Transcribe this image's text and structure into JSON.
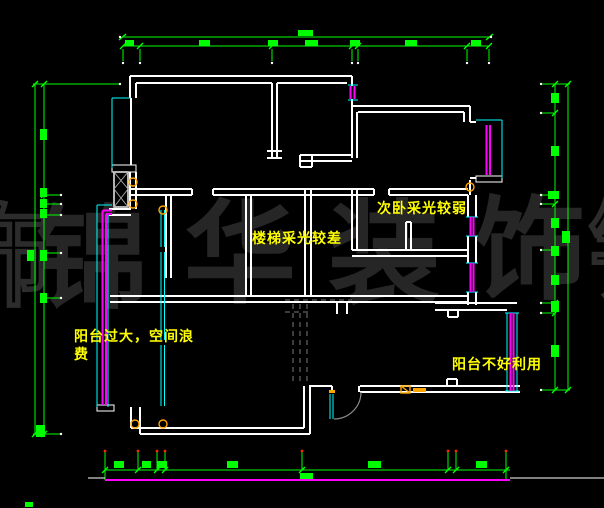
{
  "drawing": {
    "annotations": {
      "stairs": "楼梯采光较差",
      "secondary_bedroom": "次卧采光较弱",
      "left_balcony_line1": "阳台过大，空间浪",
      "left_balcony_line2": "费",
      "right_balcony": "阳台不好利用"
    },
    "watermark": {
      "char_1": "锦",
      "char_2": "华",
      "char_3": "装",
      "char_4": "饰",
      "edge_left_char": "饰",
      "edge_right_char": "锦"
    },
    "colors": {
      "background": "#000000",
      "walls": "#ffffff",
      "dimension_lines": "#00ff00",
      "window_lines": "#ff00ff",
      "glazing_lines": "#00ffff",
      "annotation_text": "#ffff00",
      "watermark": "#262626",
      "hidden_lines": "#7a7a7a",
      "symbol_orange": "#ffa500",
      "baseline_magenta": "#ff00ff"
    }
  }
}
